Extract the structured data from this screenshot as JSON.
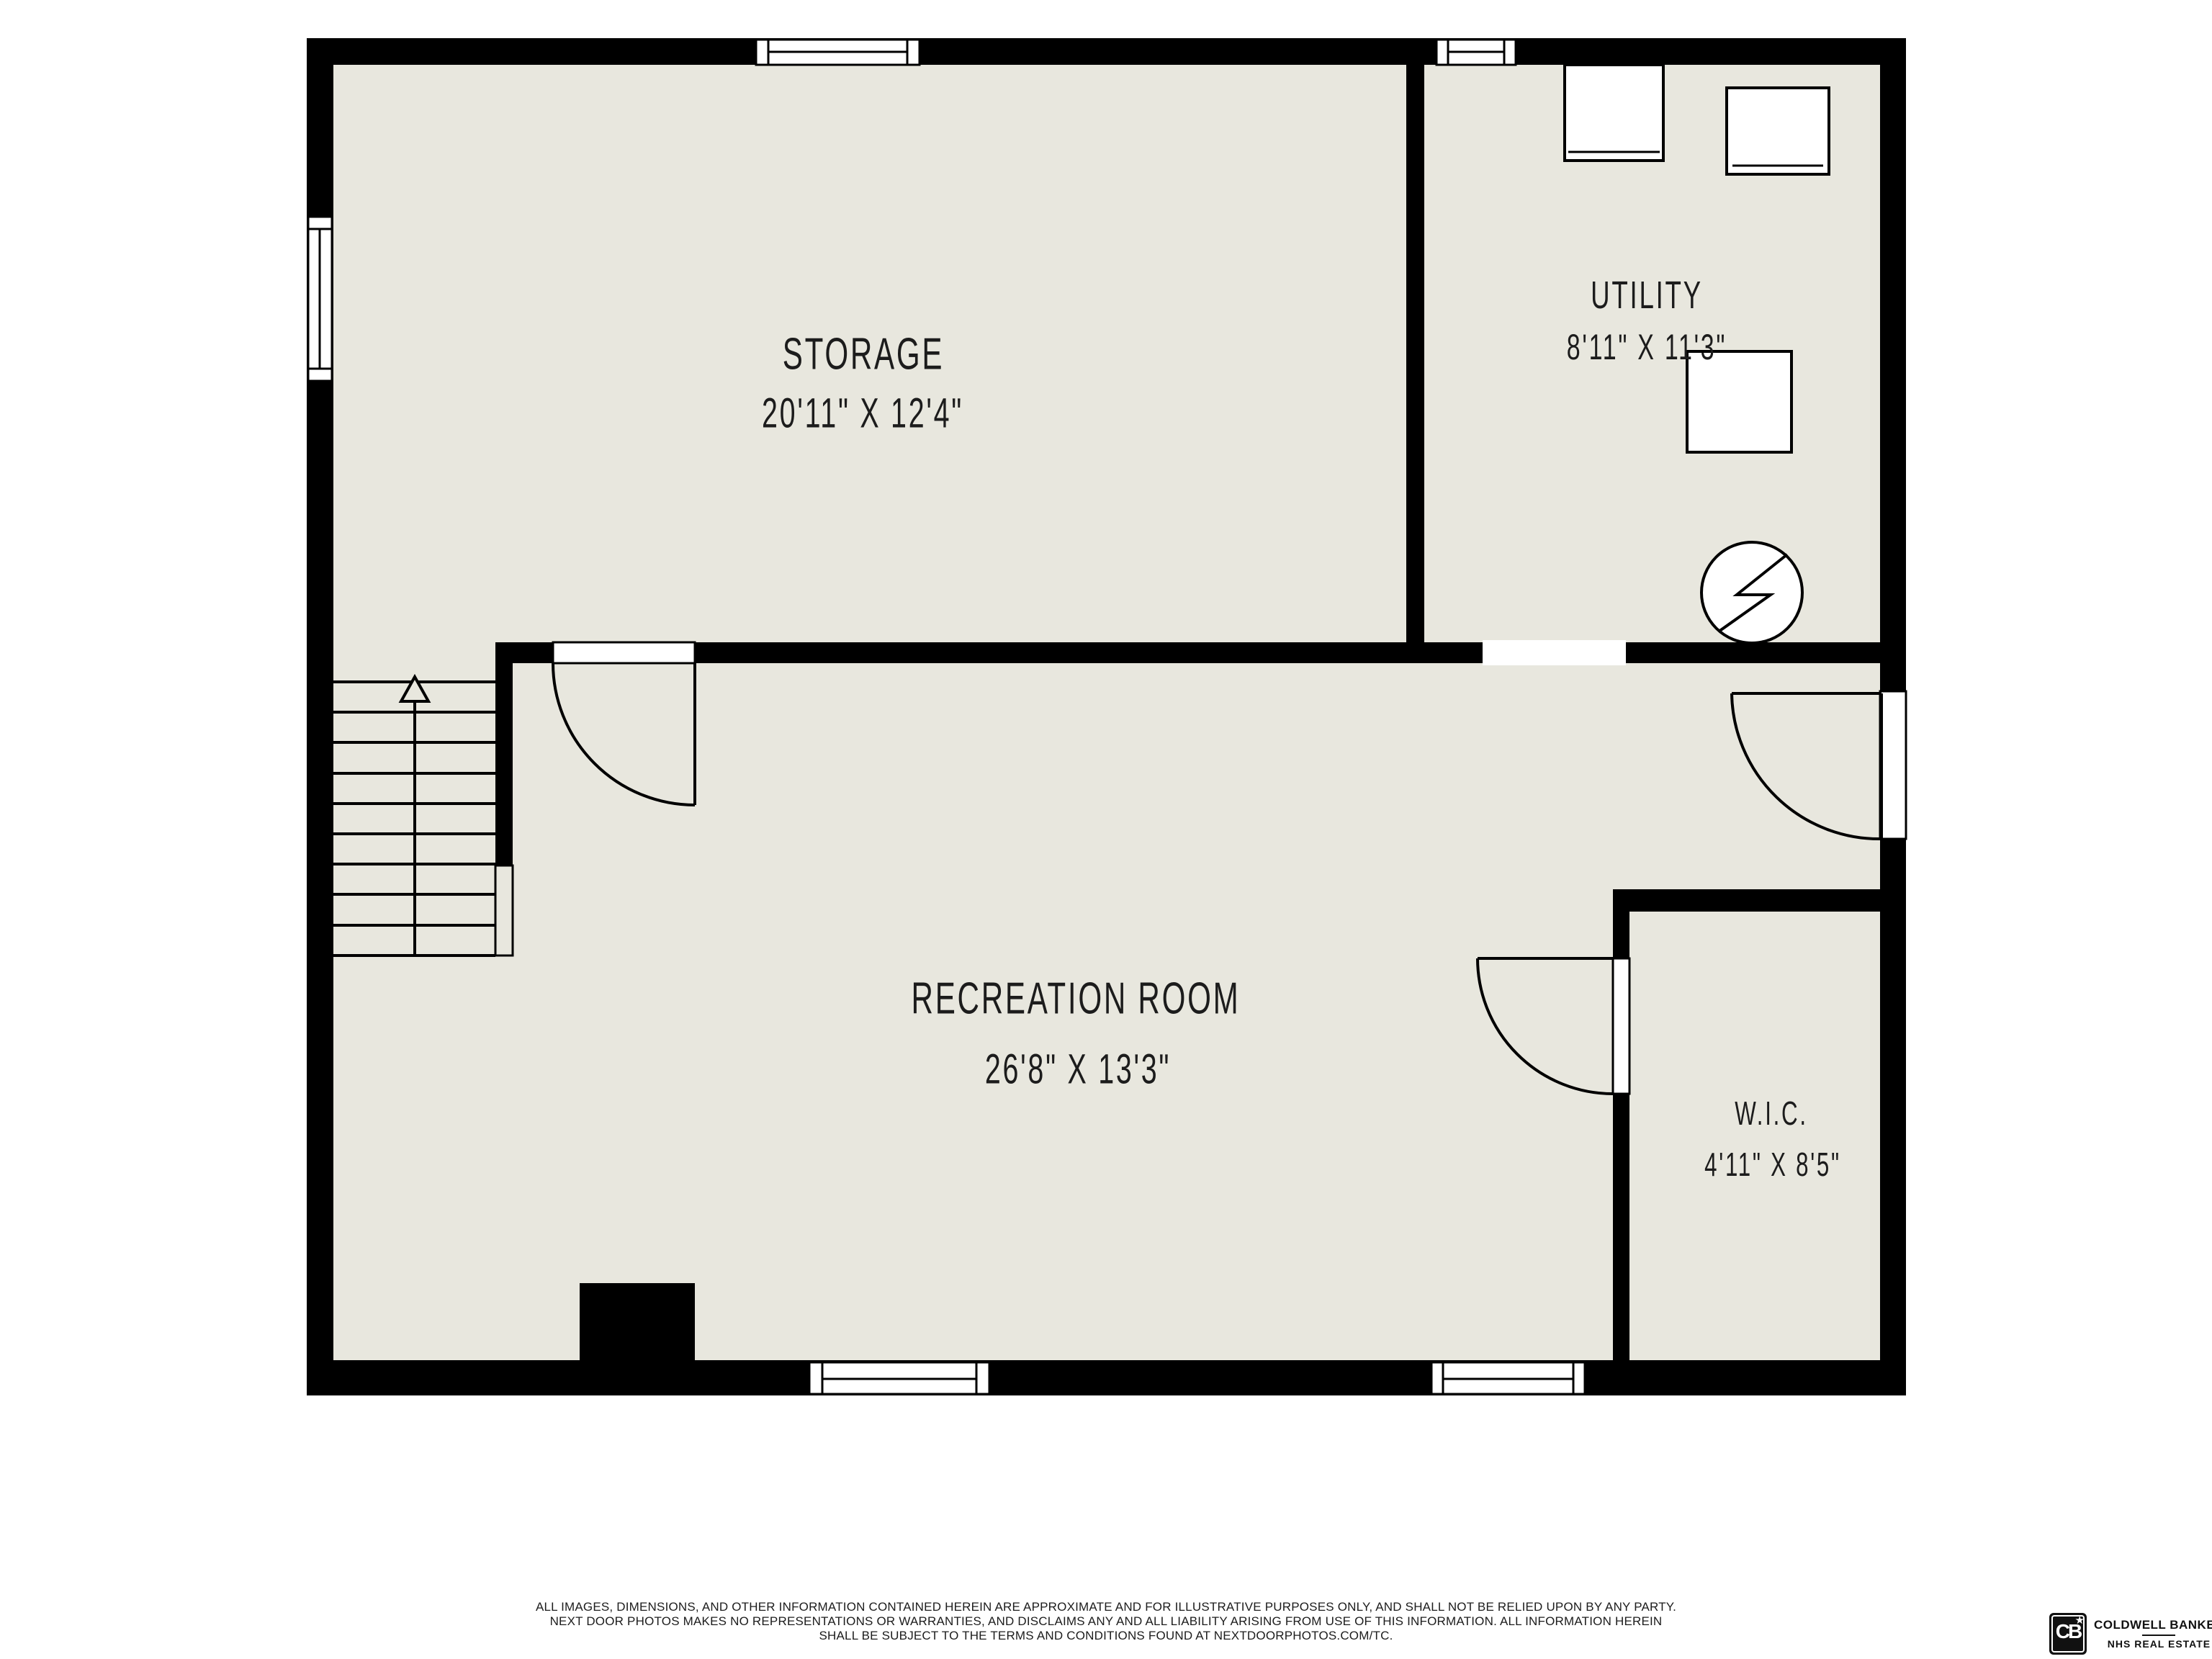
{
  "floorplan": {
    "floor_color": "#e8e7de",
    "wall_color": "#000000",
    "line_color": "#1c1c1c",
    "rooms": [
      {
        "id": "storage",
        "name": "STORAGE",
        "dimensions": "20'11\" X 12'4\""
      },
      {
        "id": "utility",
        "name": "UTILITY",
        "dimensions": "8'11\" X 11'3\""
      },
      {
        "id": "recreation",
        "name": "RECREATION ROOM",
        "dimensions": "26'8\" X 13'3\""
      },
      {
        "id": "wic",
        "name": "W.I.C.",
        "dimensions": "4'11\" X 8'5\""
      }
    ],
    "symbols": [
      "stairs-up-arrow",
      "water-heater-electric",
      "appliance-boxes",
      "door-swings",
      "window-symbols",
      "chimney-stub"
    ]
  },
  "disclaimer": {
    "lines": [
      "ALL IMAGES, DIMENSIONS, AND OTHER INFORMATION CONTAINED HEREIN ARE APPROXIMATE AND FOR ILLUSTRATIVE PURPOSES ONLY, AND SHALL NOT BE RELIED UPON BY ANY PARTY.",
      "NEXT DOOR PHOTOS MAKES NO REPRESENTATIONS OR WARRANTIES, AND DISCLAIMS ANY AND ALL LIABILITY ARISING FROM USE OF THIS INFORMATION. ALL INFORMATION HEREIN",
      "SHALL BE SUBJECT TO THE TERMS AND CONDITIONS FOUND AT NEXTDOORPHOTOS.COM/TC."
    ]
  },
  "branding": {
    "monogram": "CB",
    "star_icon": "★",
    "brand_name": "COLDWELL BANKER",
    "sub_brand": "NHS REAL ESTATE"
  }
}
